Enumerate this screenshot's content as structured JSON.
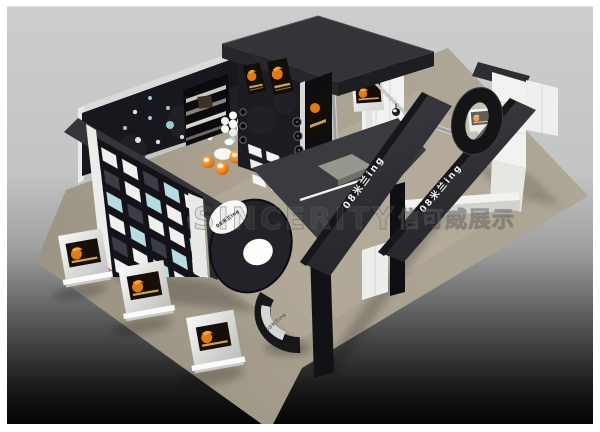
{
  "image": {
    "type": "3d-render",
    "subject": "exhibition booth concept render",
    "brand": "08米兰ing"
  },
  "watermark": {
    "latin": "SINCERITY",
    "cjk": "信可威展示"
  },
  "labels": {
    "beam_left": "08米兰ing",
    "beam_right": "08米兰ing",
    "kiosk_sign": "08米兰ing",
    "logo_disc": "08米兰ing"
  },
  "colors": {
    "background_top": "#cccece",
    "background_bottom": "#050505",
    "carpet": "#aba292",
    "structure_dark": "#2f2f33",
    "structure_black": "#141418",
    "panel_white": "#f2f2f0",
    "accent_orange": "#ee8a1f",
    "poster_gold": "#c9a455",
    "truss_gray": "#b9bdbd",
    "glass_blue": "#b7dbe2"
  },
  "decor": {
    "dot_colors": [
      "#eaf6f7",
      "#a9d9e0"
    ],
    "wall_dots": [
      [
        112,
        150,
        2.5
      ],
      [
        125,
        128,
        2
      ],
      [
        138,
        140,
        3
      ],
      [
        150,
        118,
        2
      ],
      [
        158,
        142,
        2.2
      ],
      [
        170,
        125,
        4
      ],
      [
        182,
        137,
        2
      ],
      [
        192,
        108,
        2.5
      ],
      [
        205,
        125,
        3
      ],
      [
        215,
        100,
        2
      ],
      [
        222,
        130,
        2.2
      ],
      [
        232,
        140,
        3.5
      ],
      [
        226,
        95,
        2
      ],
      [
        255,
        112,
        2.5
      ],
      [
        263,
        98,
        2
      ],
      [
        150,
        98,
        2
      ],
      [
        135,
        112,
        2.2
      ],
      [
        198,
        92,
        2
      ],
      [
        210,
        138,
        2.4
      ],
      [
        168,
        108,
        2
      ]
    ],
    "wall_pattern": [
      "wwdbw",
      "dwbwd",
      "bdwwb",
      "wbdbw",
      "dwbwd",
      "wdwbw"
    ],
    "cell_colors": {
      "w": "#f0f0ee",
      "b": "#b7dbe2",
      "d": "#3c3c44"
    }
  }
}
